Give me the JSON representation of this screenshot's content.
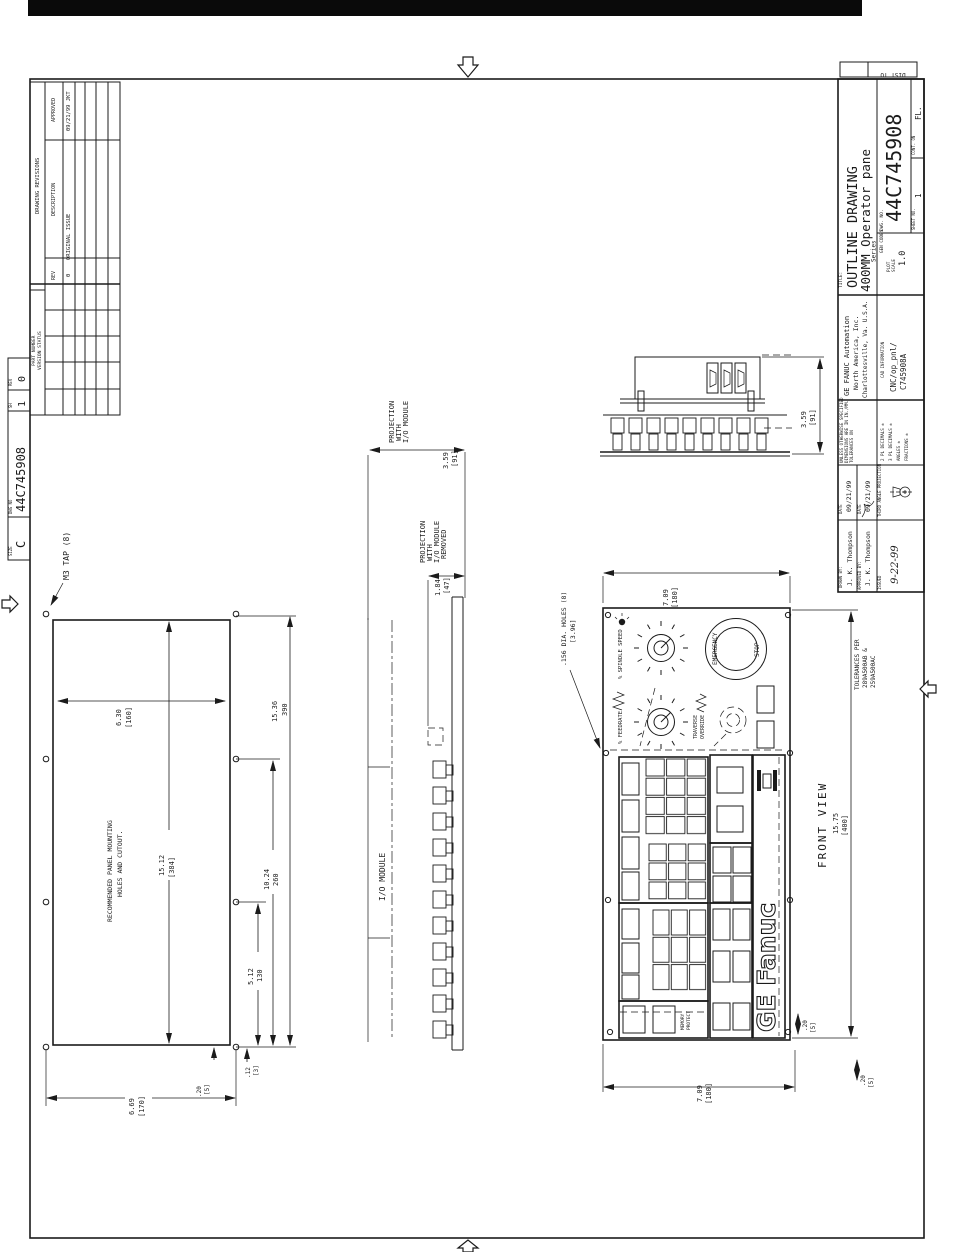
{
  "margin": {
    "dist_to": "DIST TO",
    "strip": {
      "size_label": "SIZE",
      "size": "C",
      "dwg_label": "DWG NO",
      "dwg_no": "44C745908",
      "sh_label": "SH",
      "sheet": "1",
      "rev_label": "REV",
      "rev": "0"
    }
  },
  "revtable": {
    "title": "DRAWING REVISIONS",
    "approved_label": "APPROVED",
    "description_label": "DESCRIPTION",
    "rev_label": "REV",
    "row": {
      "approved": "09/21/99 JKT",
      "description": "ORIGINAL ISSUE",
      "rev": "0"
    },
    "part_number_label": "PART NUMBER",
    "version_status_label": "VERSION STATUS"
  },
  "titleblock": {
    "title_label": "TITLE:",
    "title1": "OUTLINE DRAWING",
    "title2": "400MM Operator pane",
    "title3": "Series",
    "dwg_label": "DWG. NO.",
    "dwg_no": "44C745908",
    "sheet_label": "SHEET NO.",
    "sheet": "1",
    "cont_label": "CONT. ON",
    "cont": "FL.",
    "gencodes_label": "GEN CODES",
    "plot_label": "PLOT",
    "scale_label": "SCALE",
    "plot_scale": "1.0",
    "company1": "GE FANUC Automation",
    "company2": "North America, Inc.",
    "company3": "Charlottesville, Va. U.S.A.",
    "cad_label": "CAD INFORMATION",
    "cad1": "CNC/op_pnl/",
    "cad2": "C745908A",
    "tol1": "UNLESS OTHERWISE SPECIFIED",
    "tol2": "DIMENSIONS ARE IN IN./MM.",
    "tol3": "TOLERANCES ON",
    "tol4": "2 PL DECIMALS ±",
    "tol5": "3 PL DECIMALS ±",
    "tol6": "ANGLES ±",
    "tol7": "FRACTIONS ±",
    "date_label": "DATE",
    "drawn_date": "09/21/99",
    "approved_date": "09/21/99",
    "drawn_label": "DRAWN BY:",
    "drawn_by": "J. K. Thompson",
    "approved_label": "APPROVED BY:",
    "approved_by": "J. K. Thompson",
    "projection_label": "THIRD ANGLE PROJECTION",
    "issued_label": "ISSUED",
    "issued_date": "9-22-99"
  },
  "cutout": {
    "note": "M3 TAP (8)",
    "cap1": "RECOMMENDED PANEL MOUNTING",
    "cap2": "HOLES AND CUTOUT.",
    "dim_w": "6.30",
    "dim_w_mm": "[160]",
    "dim_h1": "15.36",
    "dim_h1_mm": "390",
    "dim_h2": "15.12",
    "dim_h2_mm": "[384]",
    "dim_h3": "10.24",
    "dim_h3_mm": "260",
    "dim_h4": "5.12",
    "dim_h4_mm": "130",
    "dim_off1": ".12",
    "dim_off1_mm": "[3]",
    "dim_off2": ".20",
    "dim_off2_mm": "[5]",
    "dim_w2": "6.69",
    "dim_w2_mm": "[170]"
  },
  "sideview": {
    "io_label": "I/O MODULE",
    "p1_l1": "PROJECTION",
    "p1_l2": "WITH",
    "p1_l3": "I/O MODULE",
    "p1_dim": "3.59",
    "p1_mm": "[91]",
    "p2_l1": "PROJECTION",
    "p2_l2": "WITH",
    "p2_l3": "I/O MODULE",
    "p2_l4": "REMOVED",
    "p2_dim": "1.84",
    "p2_mm": "[47]"
  },
  "elev": {
    "dim": "3.59",
    "mm": "[91]"
  },
  "front": {
    "caption": "FRONT VIEW",
    "holes1": ".156 DIA. HOLES (8)",
    "holes2": "[3.96]",
    "tol1": "TOLERANCES PER",
    "tol2": "289A500AB &",
    "tol3": "259A500AC",
    "spindle": "% SPINDLE SPEED",
    "feedrate": "% FEEDRATE",
    "trav1": "TRAVERSE",
    "trav2": "OVERRIDE",
    "estop1": "EMERGENCY",
    "estop2": "STOP",
    "mem1": "MEMORY",
    "mem2": "PROTECT",
    "logo": "GE Fanuc",
    "dim_wt": "7.09",
    "dim_wt_mm": "[180]",
    "dim_h": "15.75",
    "dim_h_mm": "[400]",
    "dim_o1": ".20",
    "dim_o1_mm": "[5]",
    "dim_o2": ".20",
    "dim_o2_mm": "[5]",
    "dim_wb": "7.09",
    "dim_wb_mm": "[180]"
  }
}
